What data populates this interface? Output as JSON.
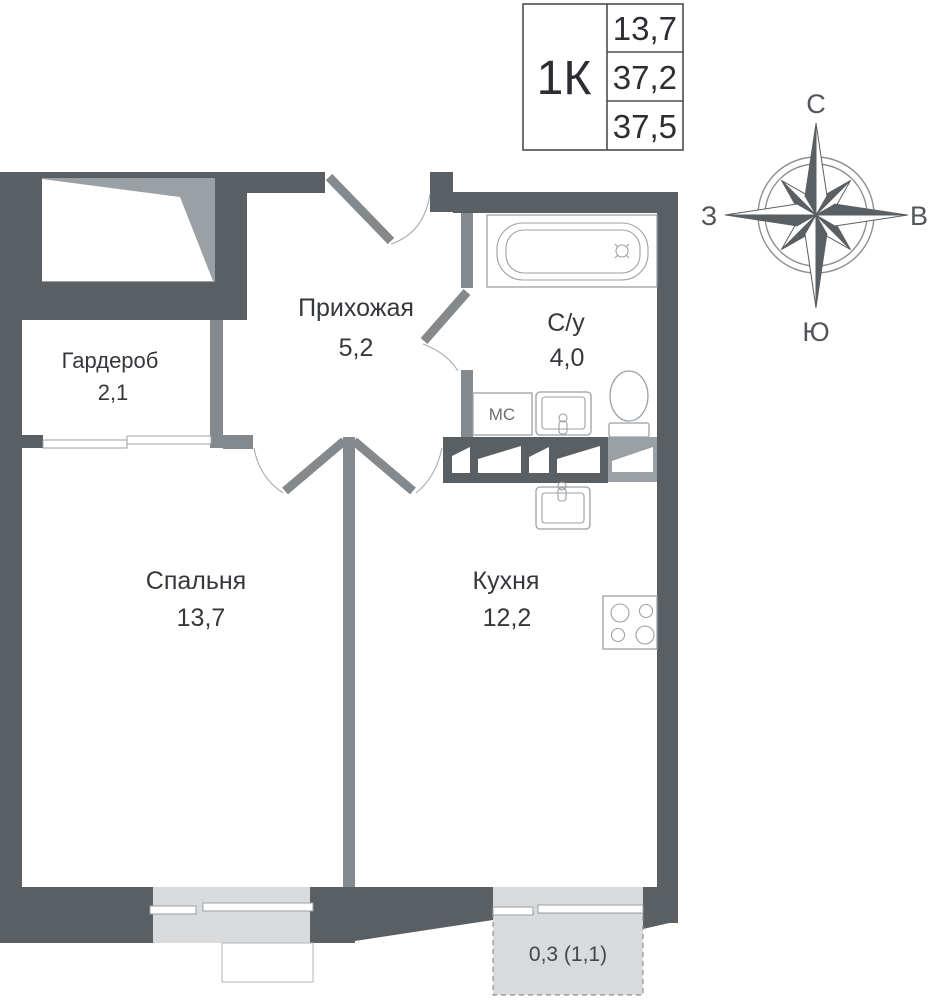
{
  "title_block": {
    "apartment_type": "1К",
    "values": [
      "13,7",
      "37,2",
      "37,5"
    ]
  },
  "compass": {
    "north": "С",
    "south": "Ю",
    "west": "З",
    "east": "В"
  },
  "rooms": {
    "wardrobe": {
      "name": "Гардероб",
      "area": "2,1"
    },
    "hallway": {
      "name": "Прихожая",
      "area": "5,2"
    },
    "bathroom": {
      "name": "С/у",
      "area": "4,0"
    },
    "bedroom": {
      "name": "Спальня",
      "area": "13,7"
    },
    "kitchen": {
      "name": "Кухня",
      "area": "12,2"
    }
  },
  "balcony": {
    "label": "0,3 (1,1)"
  },
  "appliances": {
    "washing_machine": "МС"
  },
  "colors": {
    "wall_exterior": "#5a5f63",
    "wall_interior": "#84898d",
    "shaft_fill": "#9ba0a4",
    "window_fill": "#d8dadb",
    "text": "#34383c"
  }
}
